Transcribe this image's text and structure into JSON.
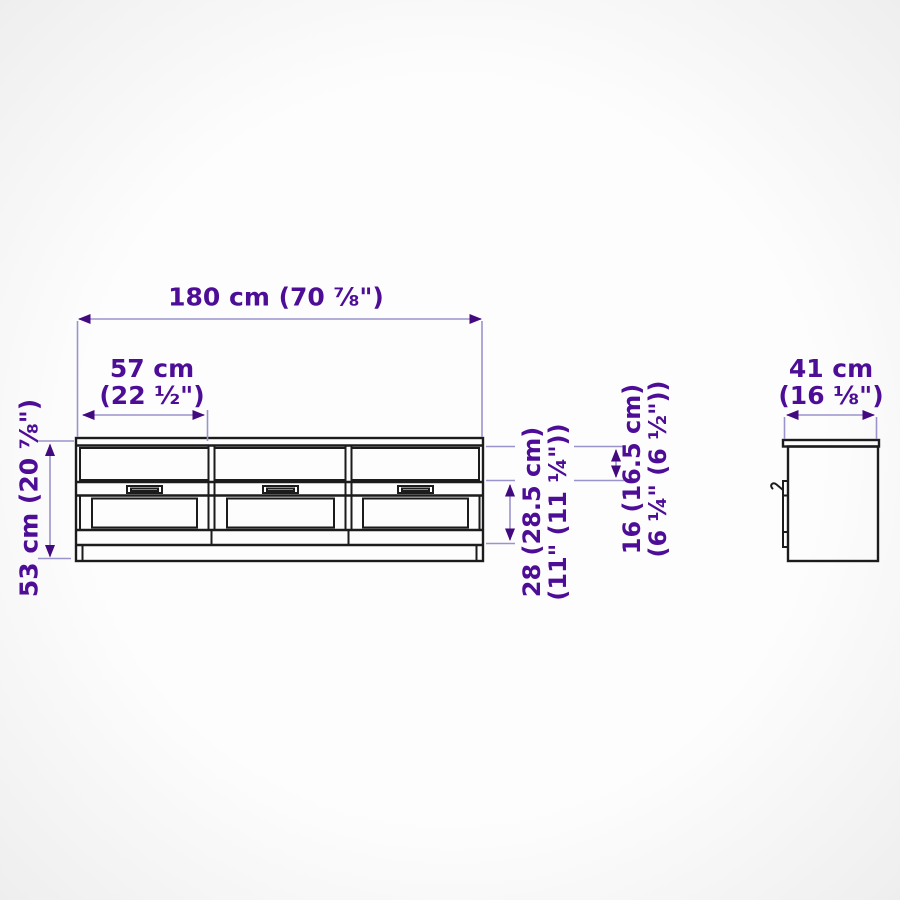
{
  "diagram_title": "tv-bench-assembled-dimensions",
  "labels": {
    "overall_width": "180 cm (70 ⅞\")",
    "bay_width_line1": "57 cm",
    "bay_width_line2": "(22 ½\")",
    "overall_height": "53 cm (20 ⅞\")",
    "depth_line1": "41 cm",
    "depth_line2": "(16 ⅛\")",
    "drawer_front_height_line1": "28 (28.5 cm)",
    "drawer_front_height_line2": "(11\" (11 ¼\"))",
    "top_shelf_height_line1": "16 (16.5 cm)",
    "top_shelf_height_line2": "(6 ¼\" (6 ½\"))"
  },
  "colors": {
    "dimension_text": "#4d0d96",
    "dimension_line": "#9a94cc",
    "arrow_head": "#43097e",
    "furniture_line": "#1c1c1c",
    "background_vignette": "#ececec"
  }
}
